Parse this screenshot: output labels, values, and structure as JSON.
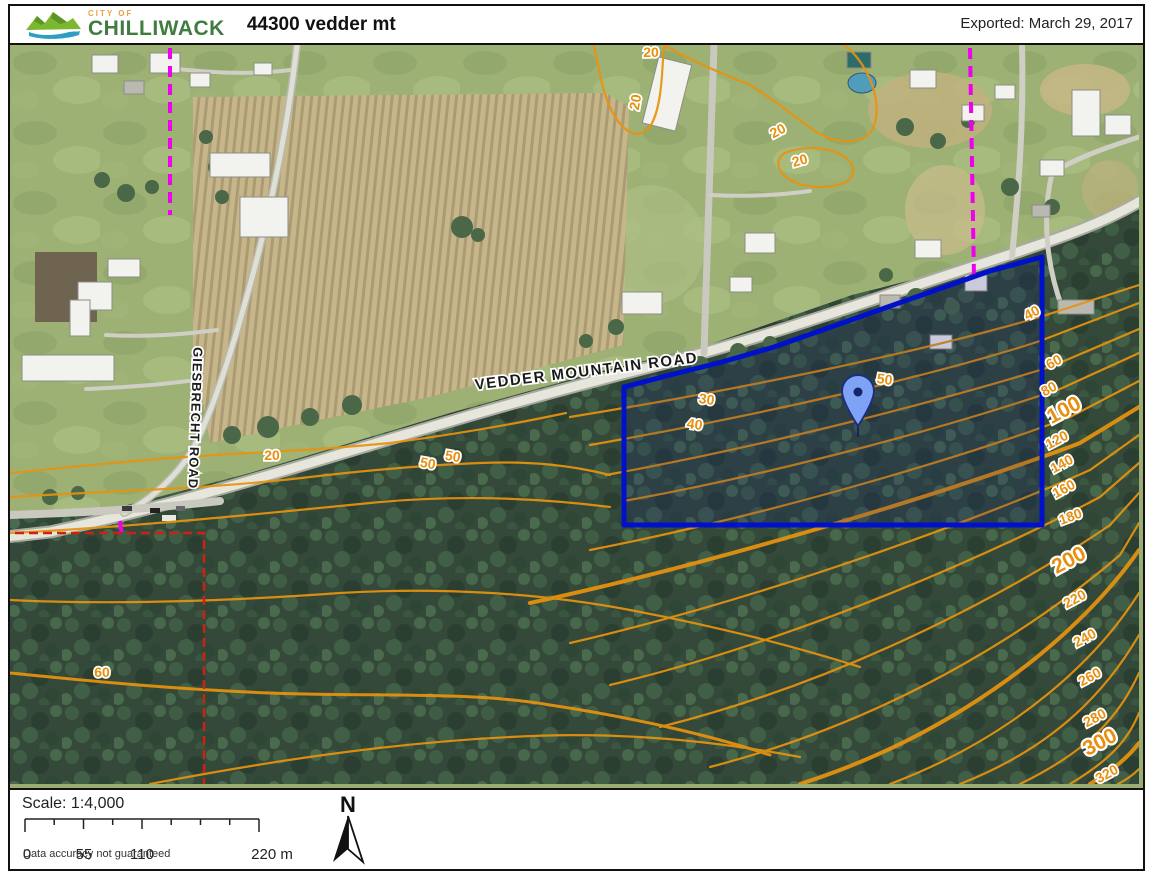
{
  "header": {
    "logo_small_text": "CITY OF",
    "logo_text": "CHILLIWACK",
    "title": "44300 vedder mt",
    "exported": "Exported: March 29, 2017"
  },
  "map": {
    "road_labels": [
      {
        "t": "VEDDER MOUNTAIN ROAD",
        "x": 577,
        "y": 331,
        "r": -7,
        "s": 15,
        "sp": 1.5
      },
      {
        "t": "GIESBRECHT ROAD",
        "x": 181,
        "y": 373,
        "r": 92,
        "s": 13,
        "sp": 1
      }
    ],
    "contour_labels": [
      {
        "t": "20",
        "x": 641,
        "y": 12,
        "r": 0
      },
      {
        "t": "20",
        "x": 630,
        "y": 58,
        "r": -80
      },
      {
        "t": "20",
        "x": 770,
        "y": 90,
        "r": -28
      },
      {
        "t": "20",
        "x": 791,
        "y": 120,
        "r": -15
      },
      {
        "t": "20",
        "x": 262,
        "y": 415,
        "r": 0
      },
      {
        "t": "30",
        "x": 696,
        "y": 359,
        "r": 8
      },
      {
        "t": "40",
        "x": 684,
        "y": 384,
        "r": 8
      },
      {
        "t": "50",
        "x": 874,
        "y": 339,
        "r": 8
      },
      {
        "t": "50",
        "x": 417,
        "y": 423,
        "r": 10
      },
      {
        "t": "50",
        "x": 442,
        "y": 416,
        "r": 10
      },
      {
        "t": "60",
        "x": 92,
        "y": 632,
        "r": 0
      },
      {
        "t": "40",
        "x": 1024,
        "y": 272,
        "r": -28
      },
      {
        "t": "60",
        "x": 1046,
        "y": 321,
        "r": -28
      },
      {
        "t": "80",
        "x": 1041,
        "y": 348,
        "r": -28
      },
      {
        "t": "100",
        "x": 1057,
        "y": 371,
        "r": -28,
        "big": true
      },
      {
        "t": "120",
        "x": 1049,
        "y": 399,
        "r": -28
      },
      {
        "t": "140",
        "x": 1054,
        "y": 423,
        "r": -28
      },
      {
        "t": "160",
        "x": 1056,
        "y": 448,
        "r": -28
      },
      {
        "t": "180",
        "x": 1062,
        "y": 476,
        "r": -20
      },
      {
        "t": "200",
        "x": 1062,
        "y": 521,
        "r": -28,
        "big": true
      },
      {
        "t": "220",
        "x": 1067,
        "y": 558,
        "r": -28
      },
      {
        "t": "240",
        "x": 1077,
        "y": 597,
        "r": -28
      },
      {
        "t": "260",
        "x": 1082,
        "y": 636,
        "r": -28
      },
      {
        "t": "280",
        "x": 1087,
        "y": 677,
        "r": -28
      },
      {
        "t": "300",
        "x": 1093,
        "y": 703,
        "r": -28,
        "big": true
      },
      {
        "t": "320",
        "x": 1099,
        "y": 733,
        "r": -28
      }
    ],
    "colors": {
      "contour": "#e88f0e",
      "parcel_outline": "#0011cc",
      "boundary_red": "#cc2211",
      "utility_magenta": "#ee00ee",
      "pin_fill": "#7ea2f5",
      "pin_dark": "#16246b"
    }
  },
  "footer": {
    "scale_text": "Scale: 1:4,000",
    "scalebar_labels": [
      "0",
      "55",
      "110",
      "220 m"
    ],
    "disclaimer": "Data accuracy not guaranteed",
    "north_label": "N"
  }
}
